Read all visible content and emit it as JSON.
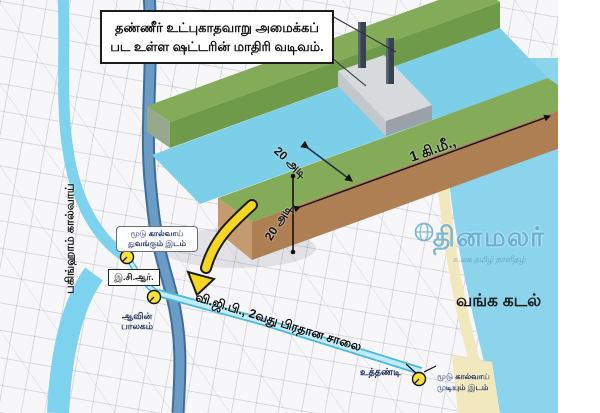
{
  "title_box": {
    "line1": "தண்ணீர் உட்புகாதவாறு அமைக்கப்",
    "line2": "பட உள்ள ஷட்டரின் மாதிரி வடிவம்."
  },
  "map": {
    "buckingham_canal": "பகிங்ஹாம் கால்வாய்",
    "canal_start": {
      "line1": "மூடு கால்வாய்",
      "line2": "துவங்கும் இடம்"
    },
    "ecr": "இ.சி.ஆர்.",
    "aavin": {
      "line1": "ஆவின்",
      "line2": "பாலகம்"
    },
    "main_road": "வி.ஜி.பி., 2வது பிரதான சாலை",
    "sea": "வங்க கடல்",
    "uthandi": "உத்தண்டி",
    "canal_end": {
      "line1": "மூடு கால்வாய்",
      "line2": "முடியும் இடம்"
    }
  },
  "shutter_model": {
    "channel_width": "20 அடி",
    "channel_depth": "20 அடி",
    "channel_length": "1 கி.மீ.,"
  },
  "watermark": {
    "name_left": "தின",
    "name_right": "மலர்",
    "tagline": "உலக தமிழ் நாளிதழ்"
  },
  "colors": {
    "canal_light": "#7dd2ee",
    "river": "#557da8",
    "sea": "#8cd3ec",
    "grass_top": "#84ac58",
    "grass_face": "#6f9a4a",
    "earth_face": "#ad7f52",
    "sand": "#f2e8bd",
    "shutter_gray": "#d7dadd",
    "marker_yellow": "#f8e13c",
    "arrow_yellow": "#f6d621"
  }
}
